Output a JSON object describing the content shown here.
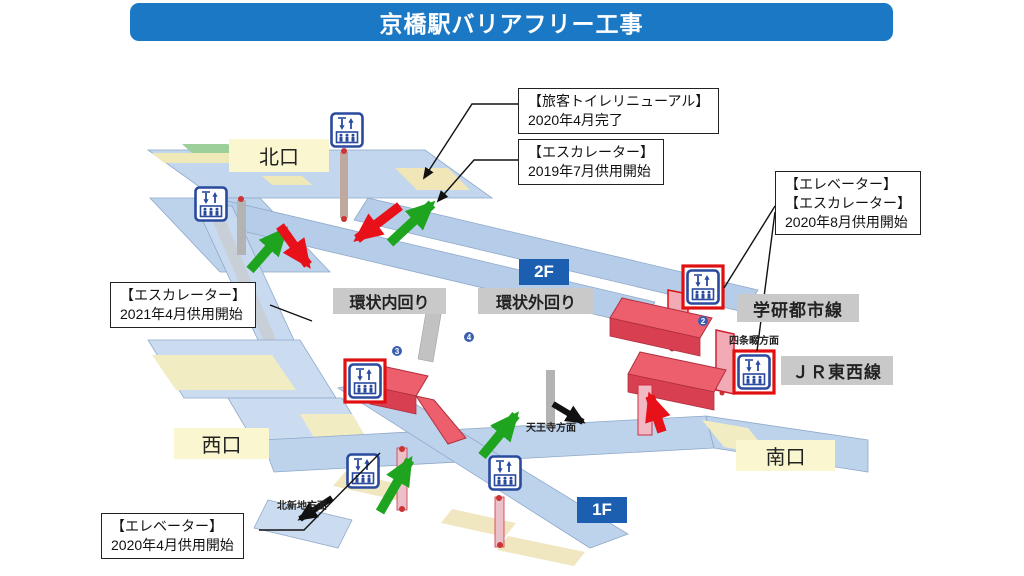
{
  "title": "京橋駅バリアフリー工事",
  "colors": {
    "title_bg": "#1B78C4",
    "floor_badge_bg": "#1C5FB0",
    "exit_label_bg": "#FAF6CF",
    "line_label_bg": "#C9C9C9",
    "deck_blue": "#BDD3EC",
    "platform_yellow": "#F2ECC2",
    "ramp_red": "#ED5F6D",
    "ramp_red_dark": "#D84052",
    "arrow_green": "#1EA41E",
    "arrow_red": "#E8111A",
    "arrow_black": "#111111",
    "icon_blue": "#2A4A9E",
    "highlight_red": "#E01010"
  },
  "callouts": {
    "toilet": {
      "line1": "【旅客トイレリニューアル】",
      "line2": "2020年4月完了"
    },
    "esc2019": {
      "line1": "【エスカレーター】",
      "line2": "2019年7月供用開始"
    },
    "ev_esc_2020": {
      "line1": "【エレベーター】",
      "line2": "【エスカレーター】",
      "line3": "2020年8月供用開始"
    },
    "esc2021": {
      "line1": "【エスカレーター】",
      "line2": "2021年4月供用開始"
    },
    "ev2020": {
      "line1": "【エレベーター】",
      "line2": "2020年4月供用開始"
    }
  },
  "map_labels": {
    "north_exit": "北口",
    "west_exit": "西口",
    "south_exit": "南口",
    "floor_2f": "2F",
    "floor_1f": "1F",
    "loop_inner": "環状内回り",
    "loop_outer": "環状外回り",
    "gakkentoshi_line": "学研都市線",
    "jr_tozai_line": "ＪＲ東西線",
    "to_shijonawate": "四条畷方面",
    "to_tennoji": "天王寺方面",
    "to_kitashinchi": "北新地方面"
  },
  "markers": {
    "m2": "2",
    "m3": "3",
    "m4": "4"
  }
}
